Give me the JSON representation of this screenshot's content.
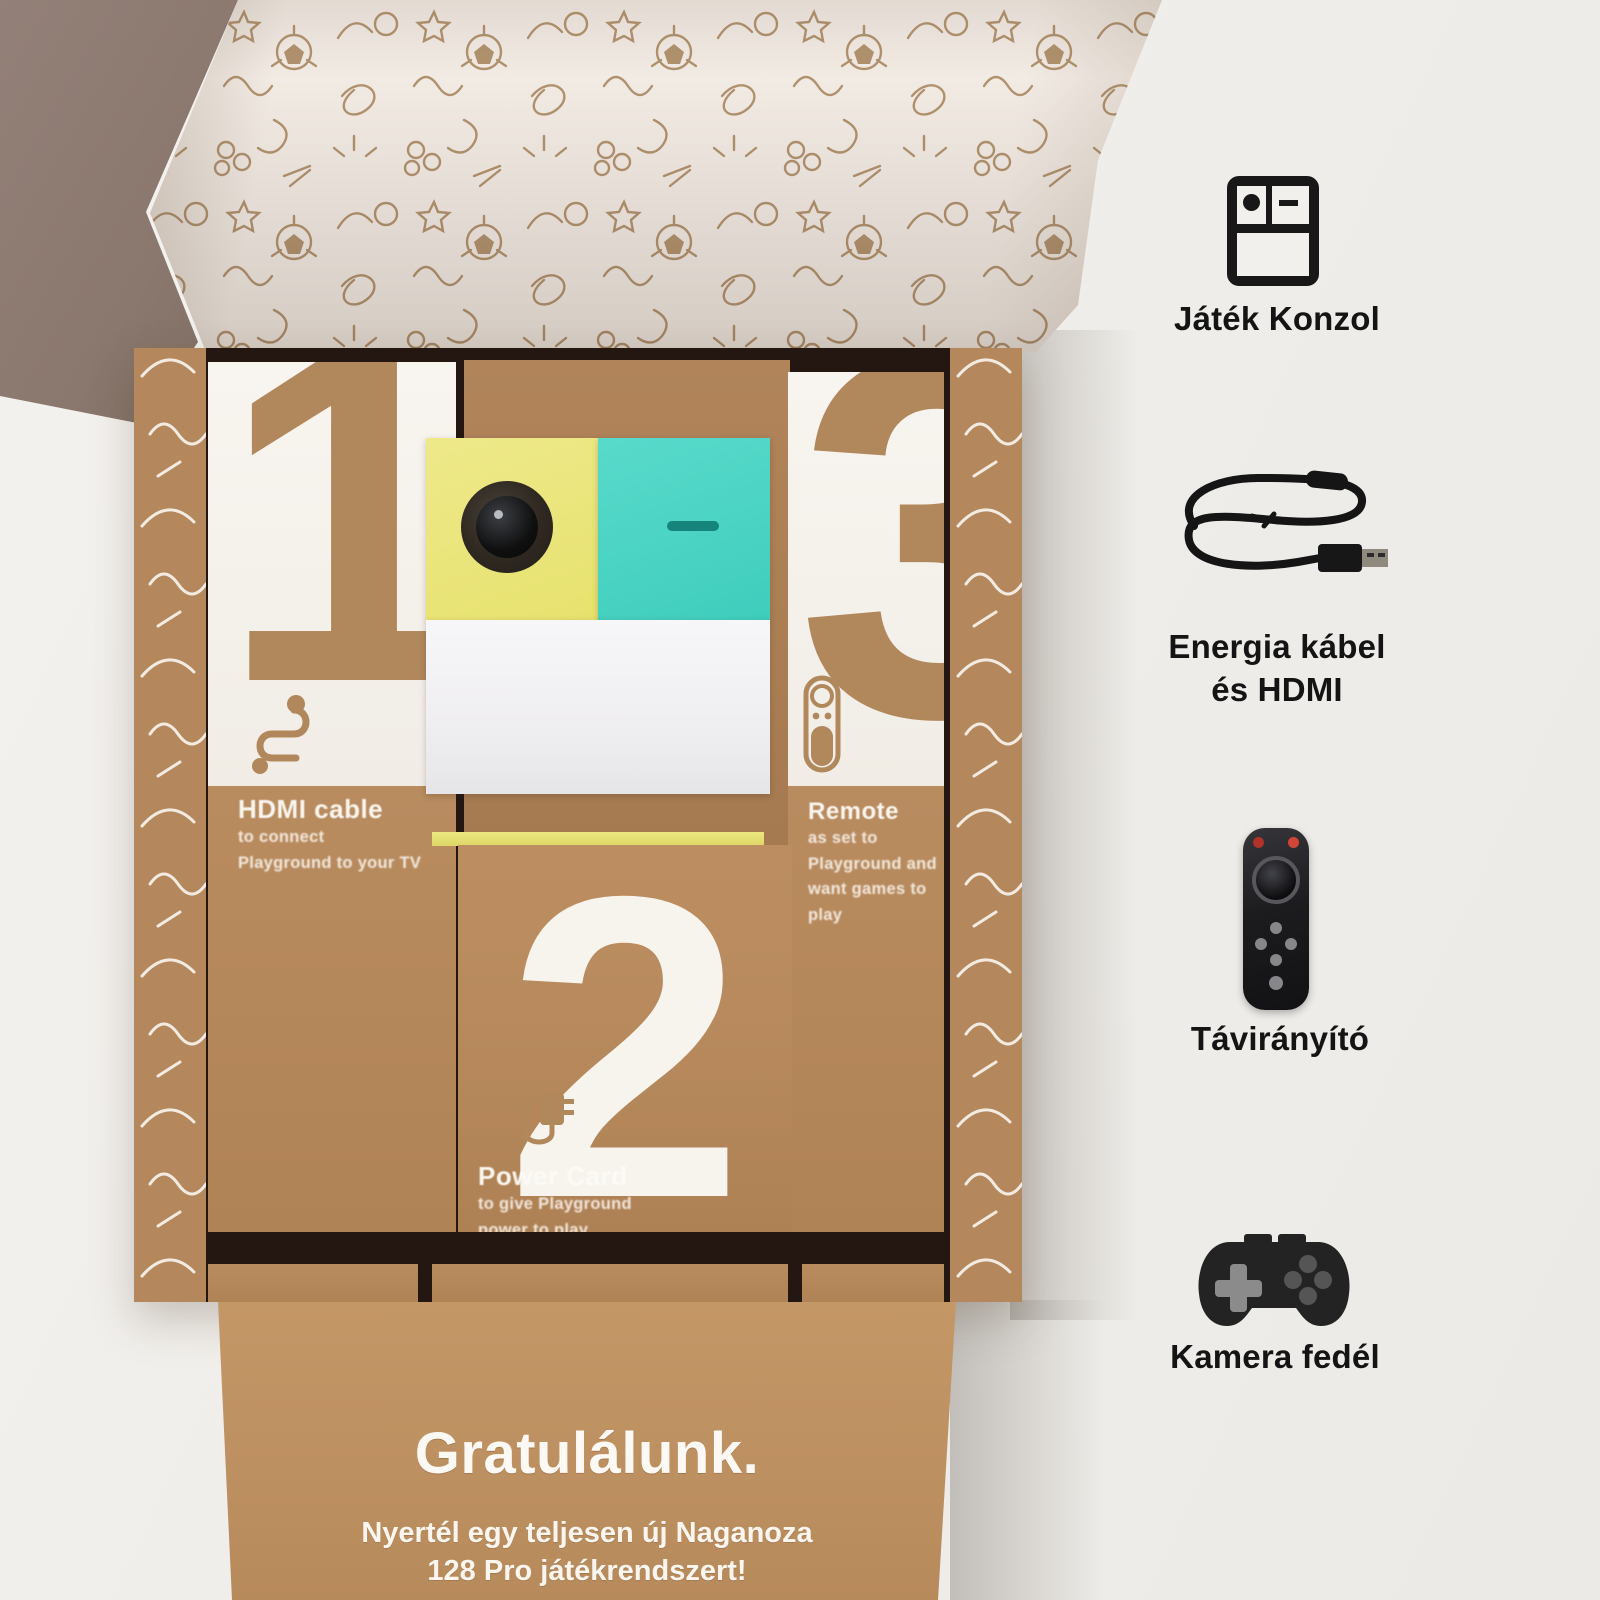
{
  "box": {
    "compartments": [
      {
        "number": "1",
        "heading": "HDMI cable",
        "line1": "to connect",
        "line2": "Playground to your TV"
      },
      {
        "number": "2",
        "heading": "Power Card",
        "line1": "to give Playground",
        "line2": "power to play"
      },
      {
        "number": "3",
        "heading": "Remote",
        "line1": "as set to",
        "line2": "Playground and",
        "line3": "want games to play"
      }
    ],
    "footer": {
      "headline": "Gratulálunk.",
      "sub1": "Nyertél egy teljesen új Naganoza",
      "sub2": "128 Pro játékrendszert!"
    }
  },
  "legend": {
    "items": [
      {
        "label": "Játék Konzol"
      },
      {
        "label": "Energia kábel",
        "label2": "és HDMI"
      },
      {
        "label": "Távirányító"
      },
      {
        "label": "Kamera fedél"
      }
    ]
  },
  "colors": {
    "kraft": "#b5885c",
    "console_yellow": "#ebe77e",
    "console_teal": "#4ed5c5",
    "ink": "#141414"
  }
}
